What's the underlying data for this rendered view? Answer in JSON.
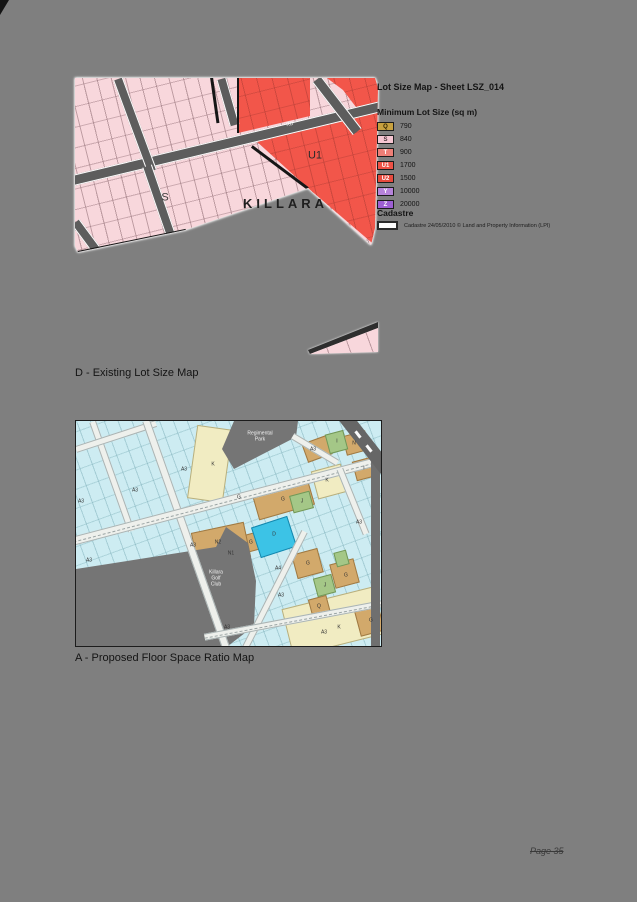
{
  "page": {
    "number_label": "Page 35"
  },
  "captions": {
    "existing": "D - Existing Lot Size Map",
    "proposed": "A - Proposed Floor Space Ratio Map"
  },
  "lot_size_map": {
    "title": "Lot Size Map - Sheet LSZ_014",
    "legend_heading": "Minimum Lot Size (sq m)",
    "legend_rows": [
      {
        "code": "Q",
        "value": "790",
        "color": "#c7a13f",
        "text_color": "#2b2100"
      },
      {
        "code": "S",
        "value": "840",
        "color": "#f6c6d2",
        "text_color": "#4a3338"
      },
      {
        "code": "T",
        "value": "900",
        "color": "#ee7f77",
        "text_color": "#ffffff"
      },
      {
        "code": "U1",
        "value": "1700",
        "color": "#ee5145",
        "text_color": "#ffffff"
      },
      {
        "code": "U2",
        "value": "1500",
        "color": "#e64a3e",
        "text_color": "#ffffff"
      },
      {
        "code": "Y",
        "value": "10000",
        "color": "#b683da",
        "text_color": "#ffffff"
      },
      {
        "code": "Z",
        "value": "20000",
        "color": "#9d5fd3",
        "text_color": "#ffffff"
      }
    ],
    "cadastre_heading": "Cadastre",
    "cadastre_note": "Cadastre 24/05/2010 © Land and Property Information (LPI)",
    "place_label": "KILLARA",
    "map_labels": [
      {
        "text": "S",
        "x": 90,
        "y": 120,
        "fs": 11,
        "color": "#3c3c3c"
      },
      {
        "text": "U1",
        "x": 240,
        "y": 78,
        "fs": 11,
        "color": "#2a2a2a"
      },
      {
        "text": "RD",
        "x": 215,
        "y": 47,
        "fs": 5,
        "color": "#ffffff",
        "rot": -13
      }
    ]
  },
  "fsr_map": {
    "park_label_lines": [
      "Regimental",
      "Park"
    ],
    "golf_label_lines": [
      "Killara",
      "Golf",
      "Club"
    ],
    "zone_labels": [
      {
        "text": "A3",
        "x": 108,
        "y": 49
      },
      {
        "text": "A3",
        "x": 59,
        "y": 70
      },
      {
        "text": "A3",
        "x": 5,
        "y": 81
      },
      {
        "text": "A3",
        "x": 13,
        "y": 140
      },
      {
        "text": "A3",
        "x": 117,
        "y": 125
      },
      {
        "text": "A3",
        "x": 237,
        "y": 29
      },
      {
        "text": "A3",
        "x": 283,
        "y": 102
      },
      {
        "text": "A3",
        "x": 205,
        "y": 175
      },
      {
        "text": "A3",
        "x": 248,
        "y": 212
      },
      {
        "text": "A3",
        "x": 151,
        "y": 207
      },
      {
        "text": "A4",
        "x": 202,
        "y": 148
      },
      {
        "text": "K",
        "x": 137,
        "y": 44
      },
      {
        "text": "K",
        "x": 251,
        "y": 60
      },
      {
        "text": "K",
        "x": 263,
        "y": 207
      },
      {
        "text": "G",
        "x": 163,
        "y": 77
      },
      {
        "text": "G",
        "x": 207,
        "y": 79
      },
      {
        "text": "G",
        "x": 175,
        "y": 122
      },
      {
        "text": "G",
        "x": 232,
        "y": 143
      },
      {
        "text": "G",
        "x": 270,
        "y": 155
      },
      {
        "text": "G",
        "x": 295,
        "y": 200
      },
      {
        "text": "N",
        "x": 278,
        "y": 23
      },
      {
        "text": "N1",
        "x": 155,
        "y": 133
      },
      {
        "text": "N2",
        "x": 142,
        "y": 122
      },
      {
        "text": "I",
        "x": 261,
        "y": 21
      },
      {
        "text": "I",
        "x": 288,
        "y": 48
      },
      {
        "text": "J",
        "x": 226,
        "y": 81
      },
      {
        "text": "J",
        "x": 249,
        "y": 165
      },
      {
        "text": "Q",
        "x": 243,
        "y": 186
      },
      {
        "text": "D",
        "x": 198,
        "y": 114
      }
    ]
  }
}
